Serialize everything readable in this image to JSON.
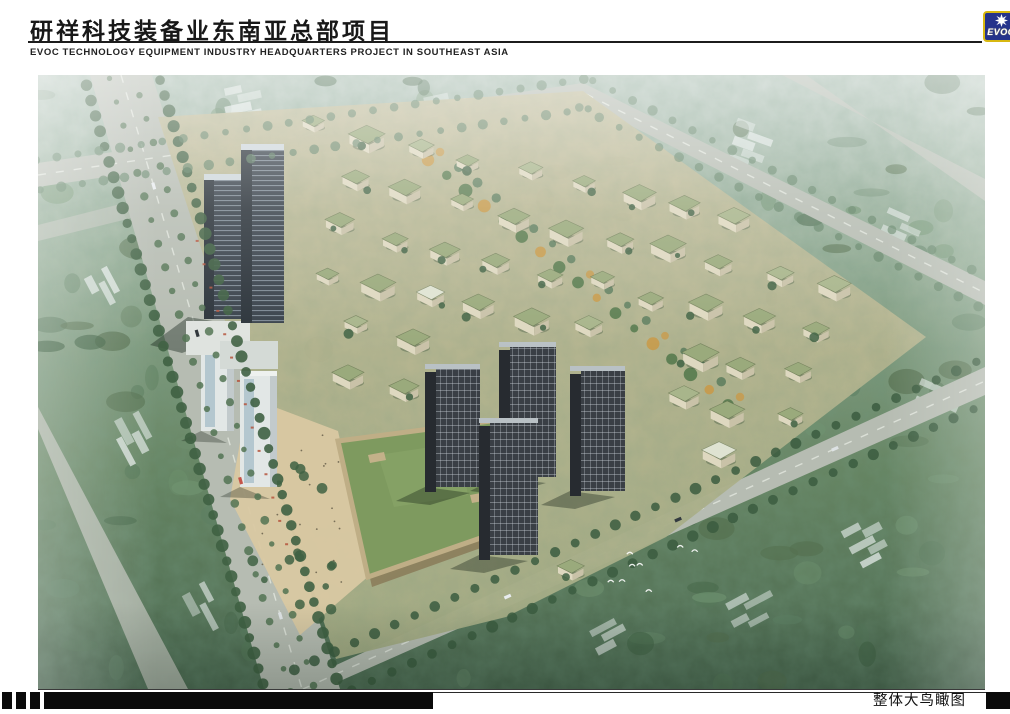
{
  "header": {
    "title_zh": "研祥科技装备业东南亚总部项目",
    "title_en": "EVOC TECHNOLOGY EQUIPMENT INDUSTRY HEADQUARTERS PROJECT IN SOUTHEAST ASIA",
    "rule_color": "#1c1c1c",
    "logo": {
      "text": "EVOC",
      "bg": "#25338b",
      "border": "#d8b810",
      "star": "#ffffff"
    }
  },
  "footer": {
    "caption": "整体大鸟瞰图",
    "bar_color": "#0a0a0a"
  },
  "colors": {
    "haze_top": "#b7c7be",
    "canopy_light": "#93ab93",
    "canopy_mid": "#64825f",
    "canopy_dark": "#49664e",
    "road": "#b6bcb2",
    "road_line": "#e4e8e0",
    "site_ground_a": "#c6be9b",
    "site_ground_b": "#a9ae86",
    "plaza": "#d9c8a2",
    "villa_roof": "#9aaa7c",
    "villa_roof_light": "#a8b58b",
    "villa_wall": "#ded8c0",
    "villa_wall_side": "#c9c2a8",
    "mall_roof": "#7e9a5f",
    "mall_edge": "#bfae86",
    "tower_dark": "#39424b",
    "tower_side": "#2b333a",
    "resi_dark": "#3a3f45",
    "resi_side": "#272b30",
    "white_building": "#e2e7e6",
    "glass_blue": "#a9bfc9",
    "tree_dark": "#3f6143",
    "tree_mid": "#56795a",
    "tree_far": "#5d7f63",
    "tree_autumn": "#c89a4a",
    "accent_red": "#b5533c"
  }
}
